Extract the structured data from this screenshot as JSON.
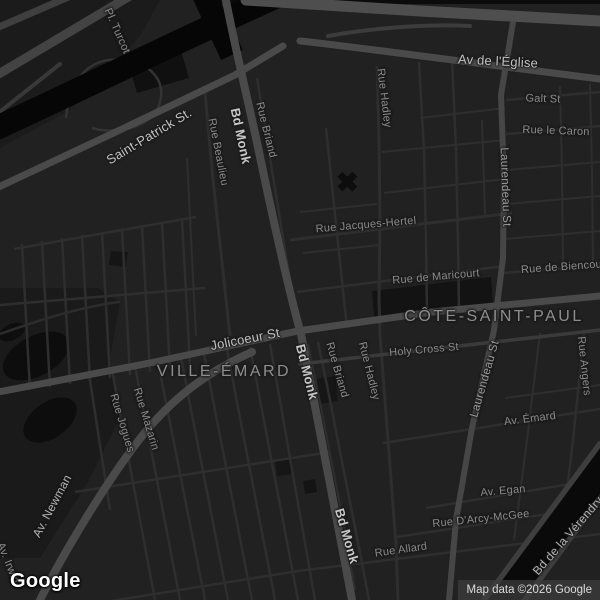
{
  "map": {
    "area_labels": [
      {
        "text": "VILLE-ÉMARD"
      },
      {
        "text": "CÔTE-SAINT-PAUL"
      }
    ],
    "street_labels": [
      {
        "text": "Pl. Turcot"
      },
      {
        "text": "Saint-Patrick St."
      },
      {
        "text": "Bd Monk"
      },
      {
        "text": "Rue Briand"
      },
      {
        "text": "Rue Beaulieu"
      },
      {
        "text": "Rue Hadley"
      },
      {
        "text": "Av de l'Église"
      },
      {
        "text": "Galt St"
      },
      {
        "text": "Rue le Caron"
      },
      {
        "text": "Laurendeau St"
      },
      {
        "text": "Rue Jacques-Hertel"
      },
      {
        "text": "Rue de Maricourt"
      },
      {
        "text": "Rue de Biencourt"
      },
      {
        "text": "Jolicoeur St"
      },
      {
        "text": "Bd Monk"
      },
      {
        "text": "Rue Briand"
      },
      {
        "text": "Rue Hadley"
      },
      {
        "text": "Holy Cross St"
      },
      {
        "text": "Laurendeau St"
      },
      {
        "text": "Rue Angers"
      },
      {
        "text": "Av. Émard"
      },
      {
        "text": "Av. Newman"
      },
      {
        "text": "Rue Jogues"
      },
      {
        "text": "Rue Mazarin"
      },
      {
        "text": "Bd Monk"
      },
      {
        "text": "Rue Allard"
      },
      {
        "text": "Av. Egan"
      },
      {
        "text": "Rue D'Arcy-McGee"
      },
      {
        "text": "Bd de la Vérendrye"
      },
      {
        "text": "Av. Irwin"
      }
    ],
    "attribution": "Map data ©2026 Google",
    "logo": "Google",
    "colors": {
      "background": "#212121",
      "arterial_road": "#4a4a4a",
      "minor_road": "#2e2e2e",
      "water": "#070707",
      "park": "#1a1a1a",
      "minor_label": "#8a8a8a",
      "arterial_label": "#c1c1c1",
      "area_label": "#8d8d8d"
    }
  }
}
